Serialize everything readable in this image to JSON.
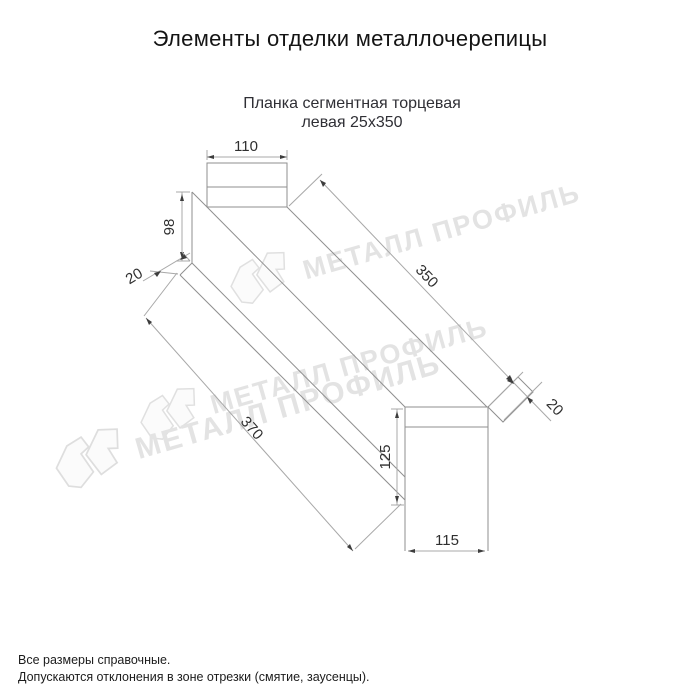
{
  "page": {
    "title": "Элементы отделки металлочерепицы",
    "subtitle_line1": "Планка сегментная торцевая",
    "subtitle_line2": "левая 25х350",
    "footer_line1": "Все размеры справочные.",
    "footer_line2": "Допускаются отклонения в зоне отрезки (смятие, заусенцы)."
  },
  "watermark": {
    "text": "МЕТАЛЛ ПРОФИЛЬ"
  },
  "diagram": {
    "type": "technical-drawing",
    "part_name": "Планка сегментная торцевая левая 25х350",
    "dimensions": {
      "top_width": "110",
      "left_height": "98",
      "left_flange": "20",
      "top_length": "350",
      "right_flange": "20",
      "right_height": "125",
      "bottom_width": "115",
      "bottom_length": "370"
    },
    "colors": {
      "line": "#8f8f8f",
      "dimension_text": "#2f2f2f",
      "watermark": "#e3e3e3",
      "title_text": "#141414"
    }
  }
}
